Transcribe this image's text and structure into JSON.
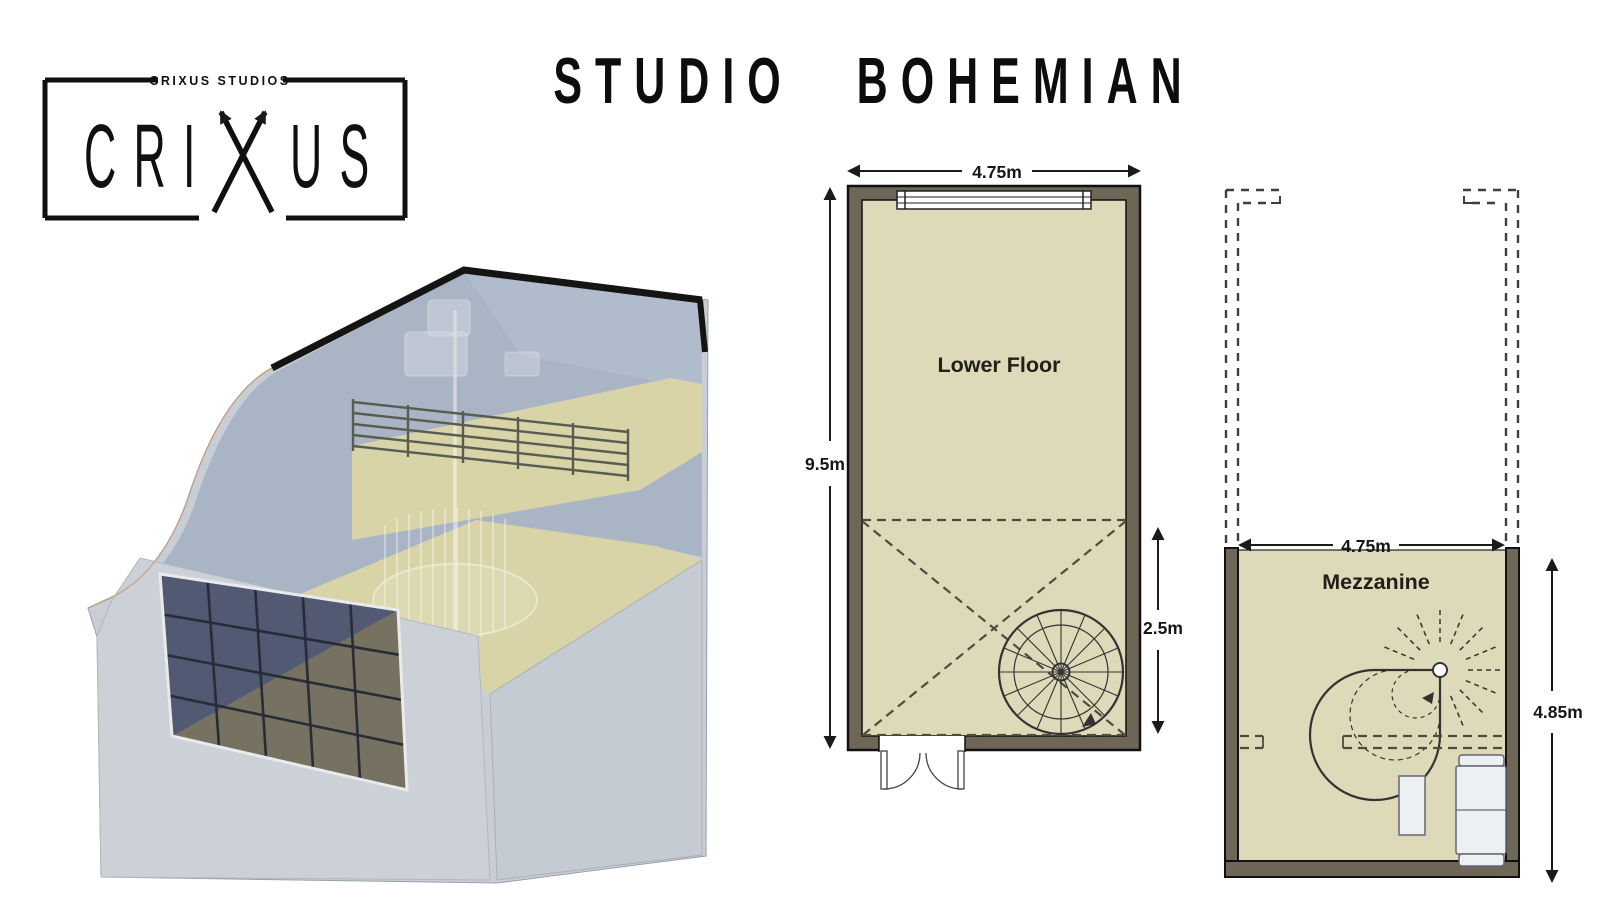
{
  "header": {
    "title": "STUDIO BOHEMIAN"
  },
  "logo": {
    "tagline": "CRIXUS STUDIOS",
    "brand_full": "CRIXUS",
    "brand_left": "CRI",
    "brand_right": "US"
  },
  "plans": {
    "lower": {
      "label": "Lower Floor",
      "width_dim": "4.75m",
      "depth_dim": "9.5m",
      "mezzanine_void_dim": "2.5m"
    },
    "mezzanine": {
      "label": "Mezzanine",
      "width_dim": "4.75m",
      "depth_dim": "4.85m"
    }
  },
  "colors": {
    "plan_floor": "#ded9b8",
    "plan_wall": "#6e6757",
    "ink": "#111111",
    "render_shell": "#c9ced6",
    "render_glass": "#a9b4c5",
    "render_floor": "#d8d4a8",
    "window_pane": "#515a72",
    "window_reflection": "#7b7361"
  }
}
